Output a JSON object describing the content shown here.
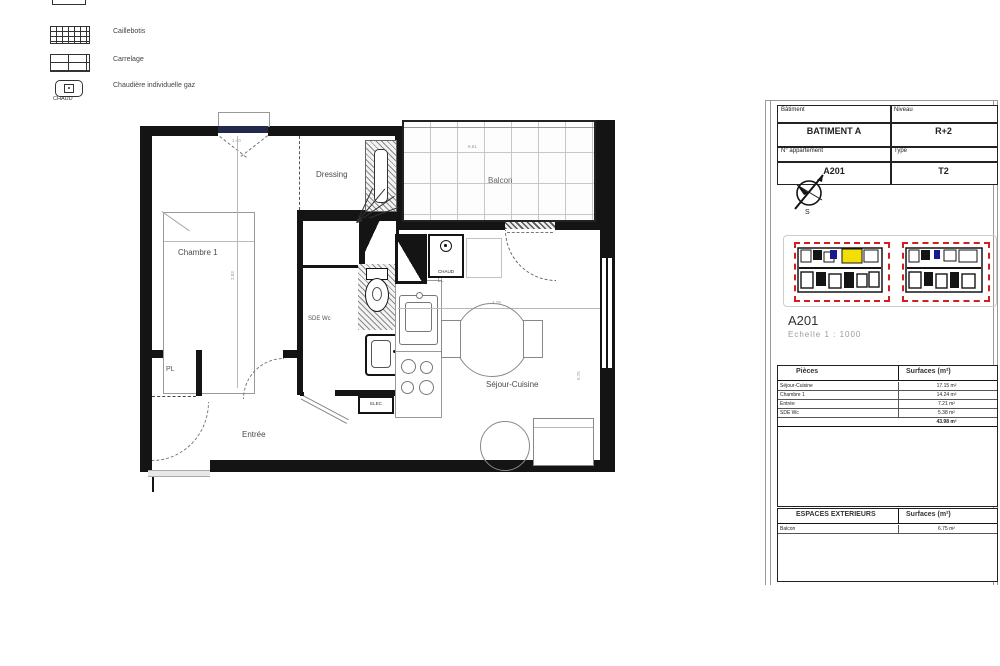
{
  "legend": {
    "items": [
      {
        "label": "Radiateur électrique",
        "symbol_text": "ELEC"
      },
      {
        "label": "Caillebotis",
        "symbol_text": ""
      },
      {
        "label": "Carrelage",
        "symbol_text": ""
      },
      {
        "label": "Chaudière individuelle gaz",
        "symbol_text": "CHAUD"
      }
    ]
  },
  "plan": {
    "room_labels": {
      "chambre": "Chambre 1",
      "dressing": "Dressing",
      "balcon": "Balcon",
      "sde": "SDE Wc",
      "sejour": "Séjour-Cuisine",
      "entree": "Entrée",
      "placard": "PL"
    },
    "fixture_labels": {
      "boiler": "CHAUD",
      "washer": "LL",
      "radiator": "ELEC"
    },
    "dimensions": {
      "sejour_width": "4.28",
      "sejour_height": "5.75",
      "chambre_width": "2.83",
      "balcon_width": "9.61",
      "window": "1.40"
    }
  },
  "titleblock": {
    "info": {
      "batiment_label": "Bâtiment",
      "batiment_value": "BATIMENT A",
      "niveau_label": "Niveau",
      "niveau_value": "R+2",
      "appartement_label": "N° appartement",
      "appartement_value": "A201",
      "type_label": "Type",
      "type_value": "T2"
    },
    "compass": {
      "south_label": "S"
    },
    "apartment_code": "A201",
    "scale": "Echelle 1 : 1000",
    "surfaces": {
      "header": {
        "pieces": "Pièces",
        "surface": "Surfaces (m²)"
      },
      "rows": [
        {
          "piece": "Séjour-Cuisine",
          "surface": "17.15 m²"
        },
        {
          "piece": "Chambre 1",
          "surface": "14.24 m²"
        },
        {
          "piece": "Entrée",
          "surface": "7.21 m²"
        },
        {
          "piece": "SDE Wc",
          "surface": "5.38 m²"
        }
      ],
      "total": "43.98 m²"
    },
    "exterior": {
      "header": {
        "label": "ESPACES EXTERIEURS",
        "surface": "Surfaces (m²)"
      },
      "rows": [
        {
          "piece": "Balcon",
          "surface": "6.75 m²"
        }
      ]
    }
  }
}
